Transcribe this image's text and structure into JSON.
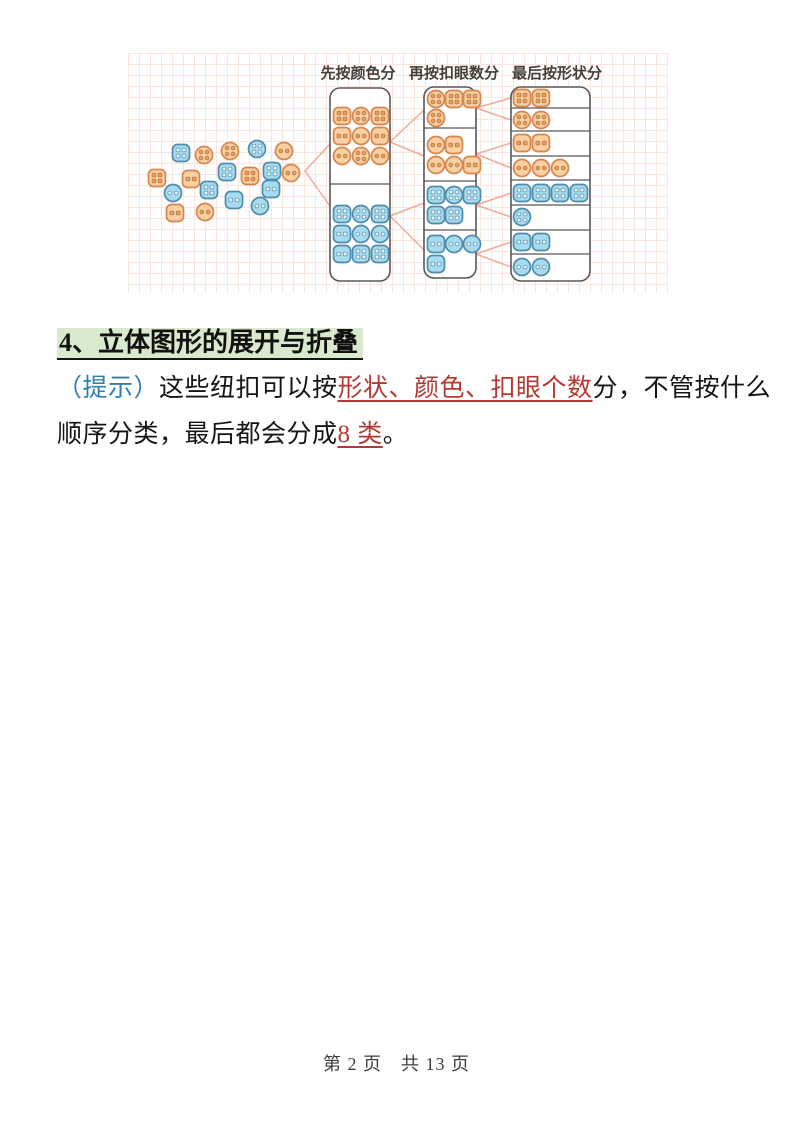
{
  "page": {
    "heading": "4、立体图形的展开与折叠",
    "paragraph": {
      "hint_label": "（提示）",
      "t1": "这些纽扣可以按",
      "red1": "形状、颜色、扣眼个数",
      "t2": "分，不管按什么",
      "t3": "顺序分类，最后都会分成",
      "red2": "8 类",
      "t4": "。"
    },
    "footer": "第 2 页　共 13 页"
  },
  "colors": {
    "orange_fill": "#f8d0a2",
    "orange_stroke": "#d8864f",
    "orange_hole": "#e2a167",
    "orange_hole_stroke": "#c0763f",
    "blue_fill": "#a9dbee",
    "blue_stroke": "#4e8dac",
    "blue_hole": "#e8f5fb",
    "blue_hole_stroke": "#5d97b4",
    "box_stroke": "#58585a",
    "connector": "#f2a89c",
    "grid": "#f8e5dc",
    "label_text": "#474038",
    "heading_highlight": "#d9e9cd",
    "hint_blue": "#2f7fb2",
    "red_text": "#b23a33",
    "body_text": "#151515",
    "footer_text": "#3d3d3d"
  },
  "diagram": {
    "width": 540,
    "height": 240,
    "grid_step": 11,
    "labels": [
      {
        "text": "先按颜色分",
        "x": 230,
        "y": 25
      },
      {
        "text": "再按扣眼数分",
        "x": 326,
        "y": 25
      },
      {
        "text": "最后按形状分",
        "x": 429,
        "y": 25
      }
    ],
    "boxes": [
      {
        "name": "color-column",
        "x": 202,
        "y": 35,
        "w": 60,
        "h": 193,
        "dividers": [
          131
        ]
      },
      {
        "name": "holes-column",
        "x": 296,
        "y": 34,
        "w": 52,
        "h": 191,
        "dividers": [
          75,
          128,
          177
        ]
      },
      {
        "name": "shape-column",
        "x": 383,
        "y": 34,
        "w": 79,
        "h": 194,
        "dividers": [
          55,
          78,
          103,
          127,
          152,
          177,
          201
        ]
      }
    ],
    "pile_buttons": [
      [
        53,
        100,
        "blue",
        "sq",
        4
      ],
      [
        76,
        102,
        "orange",
        "ci",
        4
      ],
      [
        102,
        98,
        "orange",
        "ci",
        4
      ],
      [
        129,
        96,
        "blue",
        "ci",
        4
      ],
      [
        156,
        98,
        "orange",
        "ci",
        2
      ],
      [
        29,
        125,
        "orange",
        "sq",
        4
      ],
      [
        63,
        126,
        "orange",
        "sq",
        2
      ],
      [
        99,
        119,
        "blue",
        "sq",
        4
      ],
      [
        122,
        123,
        "orange",
        "sq",
        4
      ],
      [
        144,
        118,
        "blue",
        "sq",
        4
      ],
      [
        163,
        120,
        "orange",
        "ci",
        2
      ],
      [
        45,
        140,
        "blue",
        "ci",
        2
      ],
      [
        81,
        137,
        "blue",
        "sq",
        4
      ],
      [
        106,
        147,
        "blue",
        "sq",
        2
      ],
      [
        143,
        136,
        "blue",
        "sq",
        2
      ],
      [
        47,
        160,
        "orange",
        "sq",
        2
      ],
      [
        77,
        159,
        "orange",
        "ci",
        2
      ],
      [
        132,
        153,
        "blue",
        "ci",
        2
      ]
    ],
    "sorted_buttons": [
      [
        214,
        63,
        "orange",
        "sq",
        4
      ],
      [
        233,
        63,
        "orange",
        "ci",
        4
      ],
      [
        252,
        63,
        "orange",
        "sq",
        4
      ],
      [
        214,
        83,
        "orange",
        "sq",
        2
      ],
      [
        233,
        83,
        "orange",
        "ci",
        2
      ],
      [
        252,
        83,
        "orange",
        "sq",
        2
      ],
      [
        214,
        103,
        "orange",
        "ci",
        2
      ],
      [
        233,
        103,
        "orange",
        "ci",
        4
      ],
      [
        252,
        103,
        "orange",
        "ci",
        2
      ],
      [
        214,
        161,
        "blue",
        "sq",
        4
      ],
      [
        233,
        161,
        "blue",
        "ci",
        4
      ],
      [
        252,
        161,
        "blue",
        "sq",
        4
      ],
      [
        214,
        181,
        "blue",
        "sq",
        2
      ],
      [
        233,
        181,
        "blue",
        "ci",
        2
      ],
      [
        252,
        181,
        "blue",
        "ci",
        2
      ],
      [
        214,
        201,
        "blue",
        "sq",
        2
      ],
      [
        233,
        201,
        "blue",
        "sq",
        4
      ],
      [
        252,
        201,
        "blue",
        "sq",
        4
      ],
      [
        308,
        46,
        "orange",
        "ci",
        4
      ],
      [
        326,
        46,
        "orange",
        "sq",
        4
      ],
      [
        344,
        46,
        "orange",
        "sq",
        4
      ],
      [
        308,
        65,
        "orange",
        "ci",
        4
      ],
      [
        308,
        92,
        "orange",
        "ci",
        2
      ],
      [
        326,
        92,
        "orange",
        "sq",
        2
      ],
      [
        308,
        112,
        "orange",
        "ci",
        2
      ],
      [
        326,
        112,
        "orange",
        "ci",
        2
      ],
      [
        344,
        112,
        "orange",
        "sq",
        2
      ],
      [
        308,
        142,
        "blue",
        "sq",
        4
      ],
      [
        326,
        142,
        "blue",
        "ci",
        4
      ],
      [
        344,
        142,
        "blue",
        "sq",
        4
      ],
      [
        308,
        162,
        "blue",
        "sq",
        4
      ],
      [
        326,
        162,
        "blue",
        "sq",
        4
      ],
      [
        308,
        191,
        "blue",
        "sq",
        2
      ],
      [
        326,
        191,
        "blue",
        "ci",
        2
      ],
      [
        344,
        191,
        "blue",
        "ci",
        2
      ],
      [
        308,
        211,
        "blue",
        "sq",
        2
      ],
      [
        394,
        45,
        "orange",
        "sq",
        4
      ],
      [
        413,
        45,
        "orange",
        "sq",
        4
      ],
      [
        394,
        67,
        "orange",
        "ci",
        4
      ],
      [
        413,
        67,
        "orange",
        "ci",
        4
      ],
      [
        394,
        90,
        "orange",
        "sq",
        2
      ],
      [
        413,
        90,
        "orange",
        "sq",
        2
      ],
      [
        394,
        115,
        "orange",
        "ci",
        2
      ],
      [
        413,
        115,
        "orange",
        "ci",
        2
      ],
      [
        432,
        115,
        "orange",
        "ci",
        2
      ],
      [
        394,
        140,
        "blue",
        "sq",
        4
      ],
      [
        413,
        140,
        "blue",
        "sq",
        4
      ],
      [
        432,
        140,
        "blue",
        "sq",
        4
      ],
      [
        451,
        140,
        "blue",
        "sq",
        4
      ],
      [
        394,
        164,
        "blue",
        "ci",
        4
      ],
      [
        394,
        189,
        "blue",
        "sq",
        2
      ],
      [
        413,
        189,
        "blue",
        "sq",
        2
      ],
      [
        394,
        214,
        "blue",
        "ci",
        2
      ],
      [
        413,
        214,
        "blue",
        "ci",
        2
      ]
    ],
    "connectors": [
      [
        177,
        118,
        202,
        91
      ],
      [
        177,
        118,
        202,
        153
      ],
      [
        262,
        89,
        296,
        57
      ],
      [
        262,
        89,
        296,
        103
      ],
      [
        262,
        163,
        296,
        150
      ],
      [
        262,
        163,
        296,
        197
      ],
      [
        348,
        55,
        383,
        45
      ],
      [
        348,
        55,
        383,
        67
      ],
      [
        348,
        101,
        383,
        90
      ],
      [
        348,
        101,
        383,
        115
      ],
      [
        348,
        152,
        383,
        140
      ],
      [
        348,
        152,
        383,
        164
      ],
      [
        348,
        201,
        383,
        189
      ],
      [
        348,
        201,
        383,
        214
      ]
    ]
  }
}
